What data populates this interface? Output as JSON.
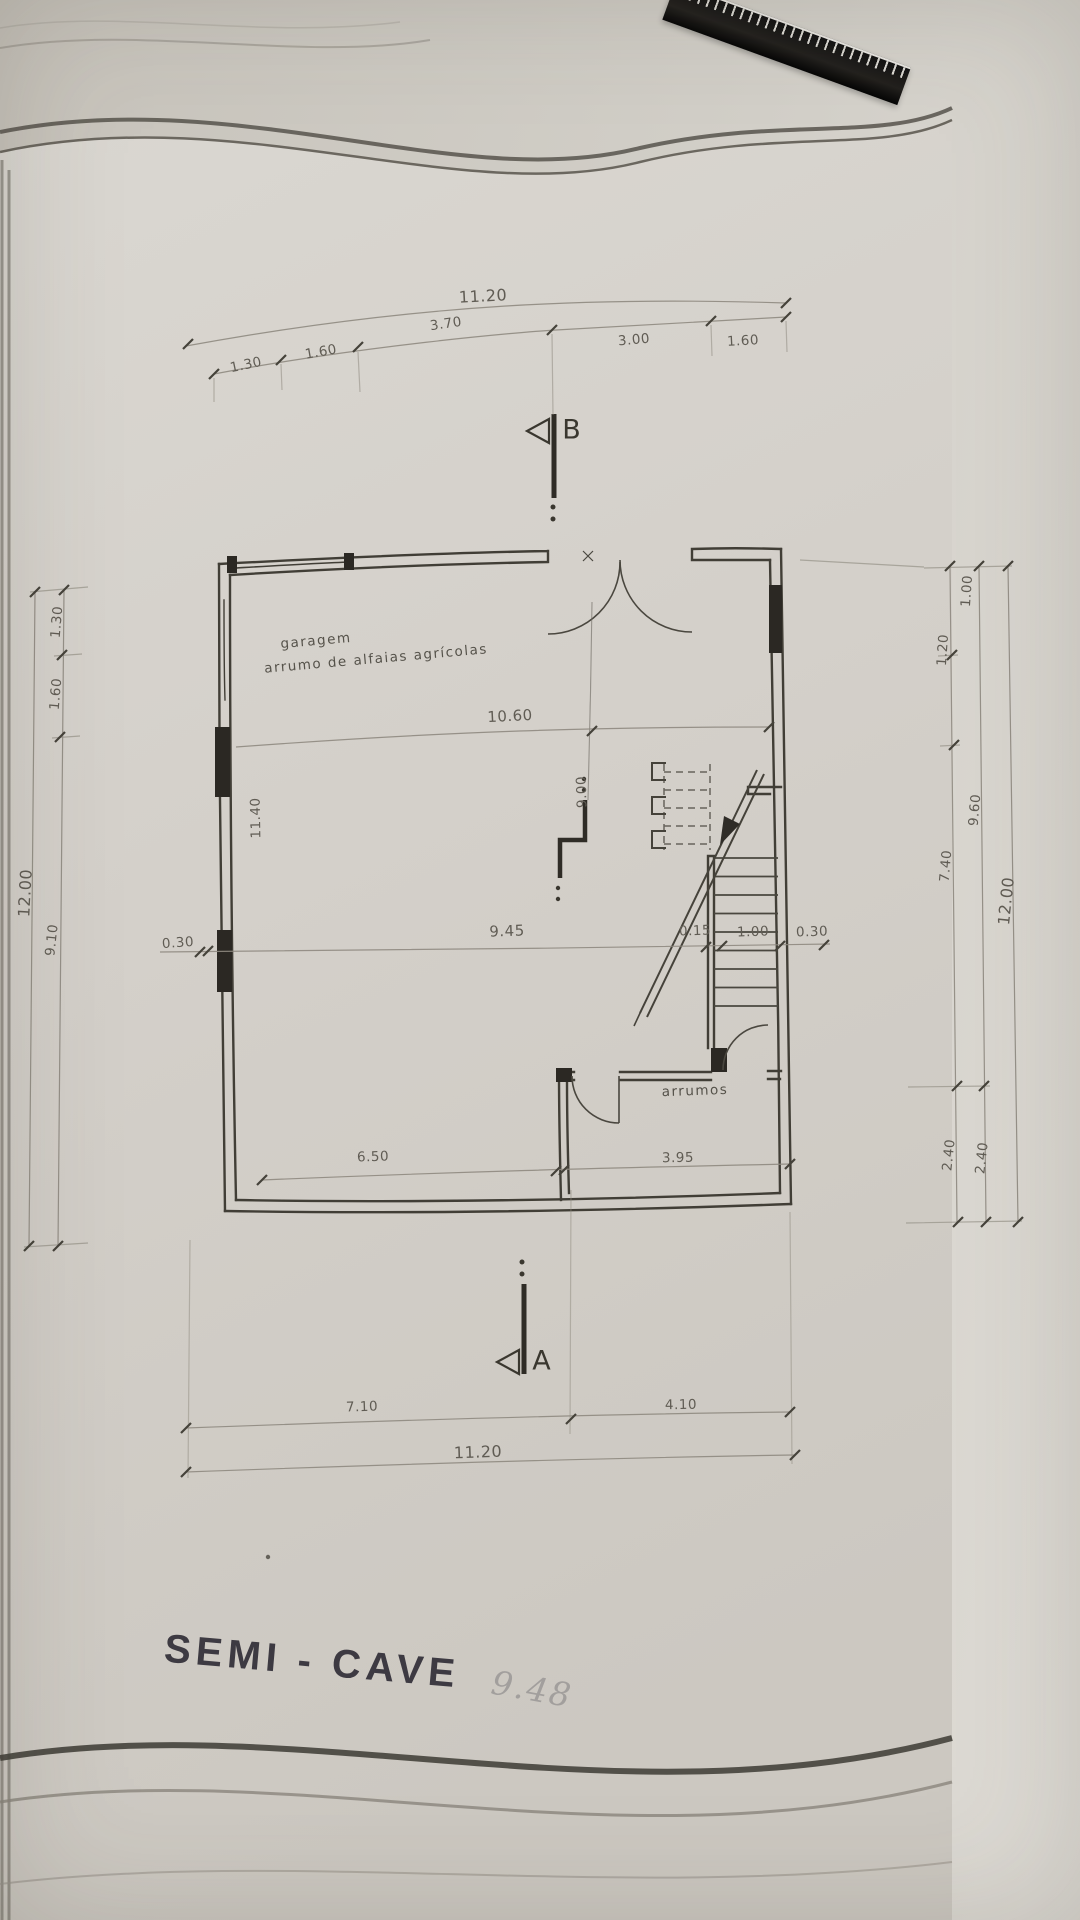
{
  "title_block": {
    "title": "SEMI - CAVE",
    "handwritten_note": "9.48"
  },
  "floor_plan": {
    "rooms": [
      {
        "name": "garagem",
        "description": "arrumo de alfaias agrícolas"
      },
      {
        "name": "arrumos"
      }
    ],
    "section_markers": [
      {
        "label": "B"
      },
      {
        "label": "A"
      }
    ]
  },
  "dimensions": {
    "top": {
      "total": "11.20",
      "segments": [
        "1.30",
        "1.60",
        "3.70",
        "3.00",
        "1.60"
      ]
    },
    "bottom": {
      "total": "11.20",
      "segments": [
        "7.10",
        "4.10"
      ]
    },
    "left": {
      "total": "12.00",
      "segments": [
        "1.30",
        "1.60",
        "9.10"
      ]
    },
    "right": {
      "total": "12.00",
      "inner_segments": [
        "1.00",
        "1.20",
        "7.40",
        "2.40"
      ],
      "middle_segments": [
        "9.60",
        "2.40"
      ]
    },
    "interior": {
      "garage_width": "10.60",
      "garage_depth": "9.00",
      "left_interior": "11.40",
      "left_wall": "0.30",
      "mid_width": "9.45",
      "stair_partition": "0.15",
      "stair_width": "1.00",
      "right_wall": "0.30",
      "bottom_left": "6.50",
      "bottom_right": "3.95"
    }
  }
}
